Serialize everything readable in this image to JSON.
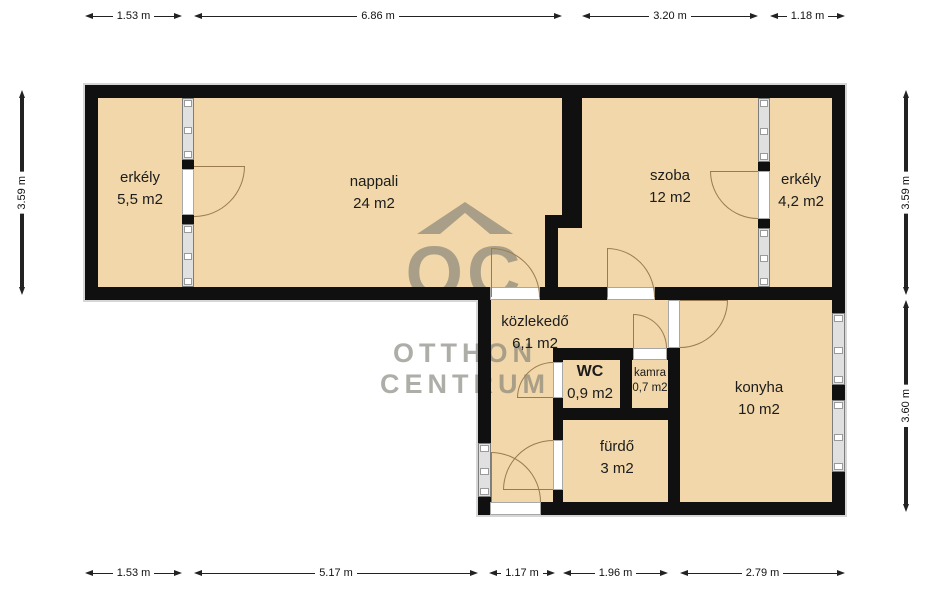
{
  "rooms": {
    "erkely_left": {
      "name": "erkély",
      "area": "5,5 m2"
    },
    "nappali": {
      "name": "nappali",
      "area": "24 m2"
    },
    "szoba": {
      "name": "szoba",
      "area": "12 m2"
    },
    "erkely_right": {
      "name": "erkély",
      "area": "4,2 m2"
    },
    "kozlekedo": {
      "name": "közlekedő",
      "area": "6,1 m2"
    },
    "wc": {
      "name": "WC",
      "area": "0,9 m2"
    },
    "kamra": {
      "name": "kamra",
      "area": "0,7 m2"
    },
    "konyha": {
      "name": "konyha",
      "area": "10 m2"
    },
    "furdo": {
      "name": "fürdő",
      "area": "3 m2"
    }
  },
  "dimensions": {
    "top": [
      {
        "label": "1.53 m"
      },
      {
        "label": "6.86 m"
      },
      {
        "label": "3.20 m"
      },
      {
        "label": "1.18 m"
      }
    ],
    "bottom": [
      {
        "label": "1.53 m"
      },
      {
        "label": "5.17 m"
      },
      {
        "label": "1.17 m"
      },
      {
        "label": "1.96 m"
      },
      {
        "label": "2.79 m"
      }
    ],
    "left": [
      {
        "label": "3.59 m"
      }
    ],
    "right": [
      {
        "label": "3.59 m"
      },
      {
        "label": "3.60 m"
      }
    ]
  },
  "watermark": {
    "monogram": "OC",
    "line1": "OTTHON",
    "line2": "CENTRUM"
  },
  "colors": {
    "room_fill": "#f1d7a9",
    "wall": "#101010",
    "door_arc": "#9a7b50"
  }
}
